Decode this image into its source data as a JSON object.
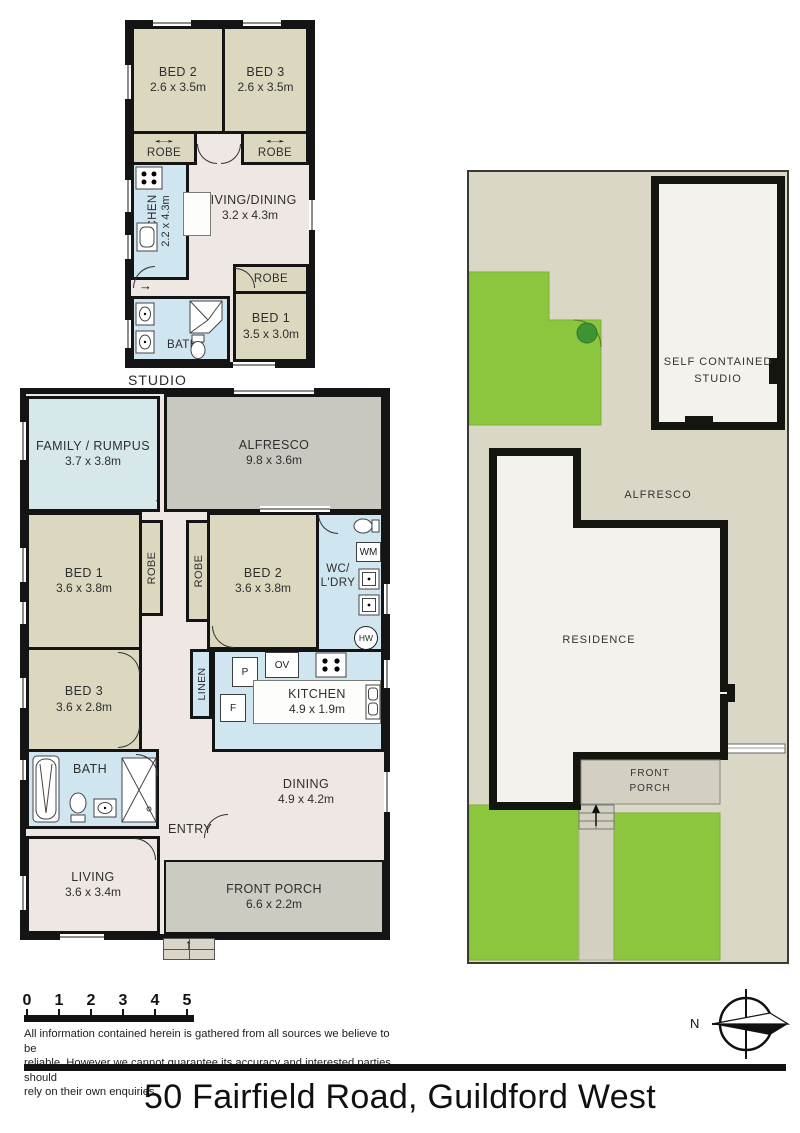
{
  "title": "50 Fairfield Road, Guildford West",
  "icons": {
    "down_arrow": "↓",
    "up_arrow": "↑",
    "right_arrow": "→",
    "leftright_arrow": "↔"
  },
  "studio": {
    "caption": "STUDIO",
    "bed2": {
      "name": "BED 2",
      "dims": "2.6 x 3.5m"
    },
    "bed3": {
      "name": "BED 3",
      "dims": "2.6 x 3.5m"
    },
    "robe_left": {
      "name": "ROBE"
    },
    "robe_right": {
      "name": "ROBE"
    },
    "kitchen": {
      "name": "KITCHEN",
      "dims": "2.2 x 4.3m"
    },
    "living": {
      "name": "LIVING/DINING",
      "dims": "3.2 x 4.3m"
    },
    "robe_bed1": {
      "name": "ROBE"
    },
    "bed1": {
      "name": "BED 1",
      "dims": "3.5 x 3.0m"
    },
    "bath": {
      "name": "BATH"
    }
  },
  "house": {
    "family": {
      "name": "FAMILY / RUMPUS",
      "dims": "3.7 x 3.8m"
    },
    "alfresco": {
      "name": "ALFRESCO",
      "dims": "9.8 x 3.6m"
    },
    "bed1": {
      "name": "BED 1",
      "dims": "3.6 x 3.8m"
    },
    "robe1": {
      "name": "ROBE"
    },
    "robe2": {
      "name": "ROBE"
    },
    "bed2": {
      "name": "BED 2",
      "dims": "3.6 x 3.8m"
    },
    "wc_ldry": {
      "name": "WC/\nL'DRY"
    },
    "wm": "WM",
    "hw": "HW",
    "bed3": {
      "name": "BED 3",
      "dims": "3.6 x 2.8m"
    },
    "linen": {
      "name": "LINEN"
    },
    "pantry": "P",
    "fridge": "F",
    "oven": "OV",
    "kitchen": {
      "name": "KITCHEN",
      "dims": "4.9 x 1.9m"
    },
    "bath": {
      "name": "BATH"
    },
    "dining": {
      "name": "DINING",
      "dims": "4.9 x 4.2m"
    },
    "entry": {
      "name": "ENTRY"
    },
    "living": {
      "name": "LIVING",
      "dims": "3.6 x 3.4m"
    },
    "porch": {
      "name": "FRONT PORCH",
      "dims": "6.6 x 2.2m"
    }
  },
  "site": {
    "studio": "SELF CONTAINED\nSTUDIO",
    "alfresco": "ALFRESCO",
    "residence": "RESIDENCE",
    "porch": "FRONT\nPORCH"
  },
  "footer": {
    "scale_ticks": [
      "0",
      "1",
      "2",
      "3",
      "4",
      "5"
    ],
    "compass_label": "N",
    "disclaimer": "All information contained herein is gathered from all sources we believe to be\nreliable. However we cannot guarantee its accuracy and interested parties should\nrely on their own enquiries."
  },
  "colors": {
    "wall": "#141414",
    "hall": "#efe7e3",
    "bedroom": "#dcd8c0",
    "wet_area": "#cfe5f0",
    "family": "#d7e8ea",
    "alfresco": "#c9c8c0",
    "porch": "#cbcbc1",
    "site_background": "#dad7c6",
    "lawn": "#8cc63e",
    "building": "#f3f2ec",
    "tree": "#3e9433"
  }
}
